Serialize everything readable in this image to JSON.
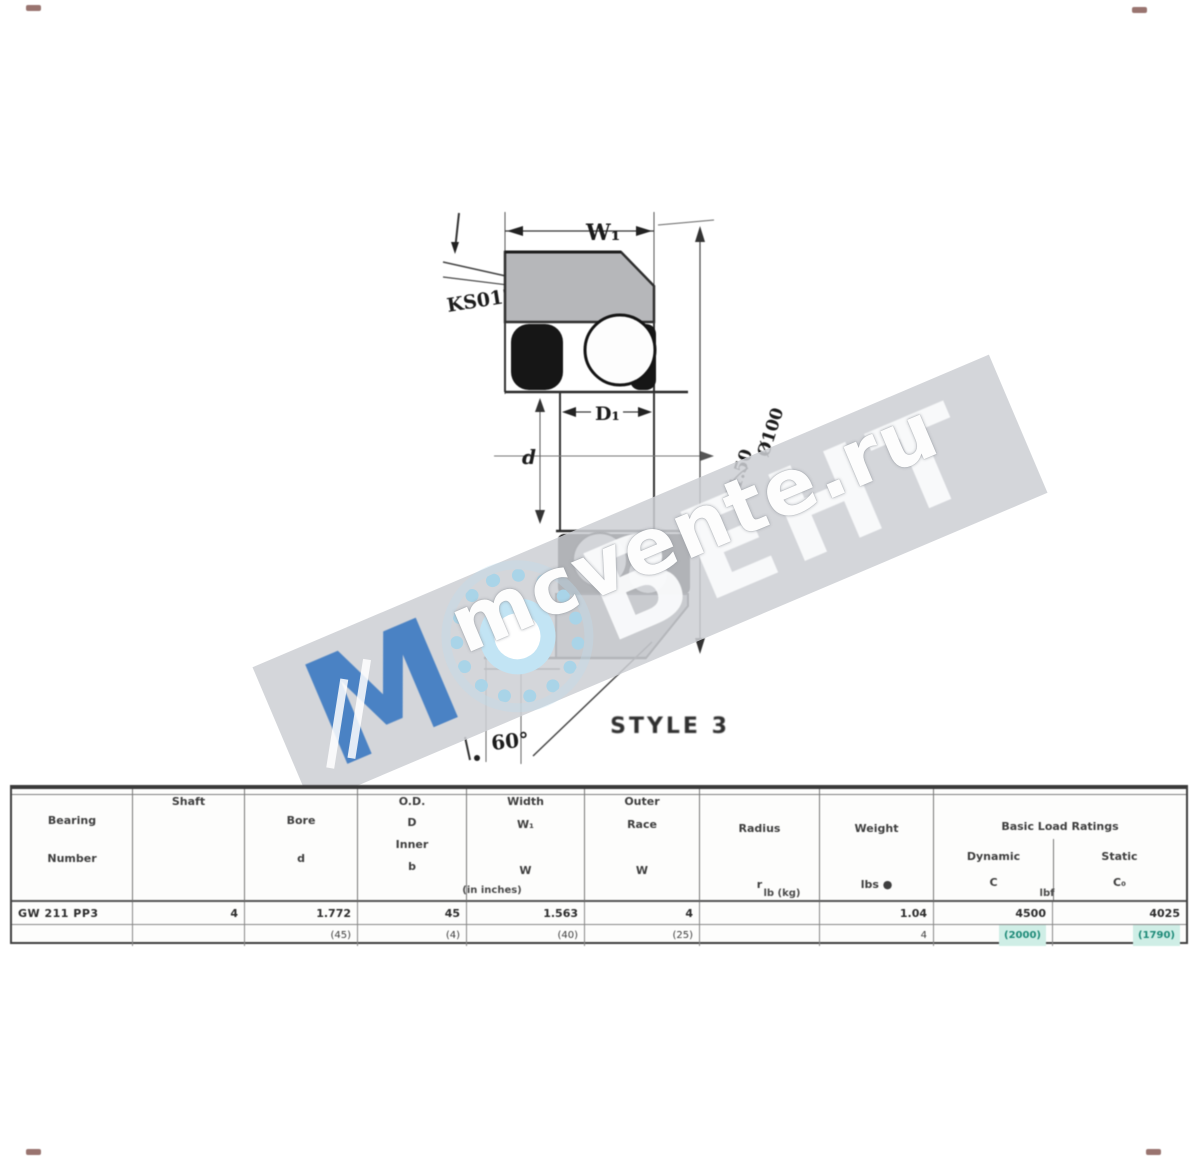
{
  "watermark": {
    "brand_m": "М",
    "brand_rest": "ВЕНТ",
    "site": "mcvente.ru",
    "band_color": "#cfd1d5",
    "blue": "#4a82c4",
    "light_blue": "#a9d4e8"
  },
  "diagram": {
    "labels": {
      "w1": "W₁",
      "d1": "D₁",
      "d": "d",
      "angle": "60°",
      "style": "STYLE 3",
      "callout_left": "KS012",
      "callout_right_1": "Ø1.50",
      "callout_right_2": "Ø100"
    },
    "colors": {
      "ring_gray": "#b6b7ba",
      "line": "#2a2a2a",
      "seal_black": "#161616"
    }
  },
  "table": {
    "header": {
      "col1": [
        "Bearing",
        "Number"
      ],
      "col2": [
        "Shaft"
      ],
      "col3": [
        "Bore",
        "d"
      ],
      "col4": [
        "O.D.",
        "D",
        "Inner",
        "b"
      ],
      "col5": [
        "Width",
        "W₁",
        "W"
      ],
      "col6": [
        "Outer",
        "Race",
        "W"
      ],
      "col7": [
        "Radius",
        "r"
      ],
      "col8": [
        "Weight",
        "lbs ●"
      ],
      "group": "Basic Load Ratings",
      "sub1": "Dynamic",
      "sub2": "Static",
      "sym1": "C",
      "sym2": "C₀",
      "note_left": "(in inches)",
      "note_mid": "lb (kg)",
      "note_right": "lbf"
    },
    "rows": [
      {
        "c1": "GW 211 PP3",
        "c2": "4",
        "c3": "1.772",
        "c4": "45",
        "c5": "1.563",
        "c6": "4",
        "c7": "",
        "c8": "1.04",
        "c9a": "4500",
        "c9b": "4025"
      },
      {
        "c1": "",
        "c2": "",
        "c3": "(45)",
        "c4": "(4)",
        "c5": "(40)",
        "c6": "(25)",
        "c7": "",
        "c8": "4",
        "c9a": "(2000)",
        "c9b": "(1790)"
      }
    ],
    "highlight": {
      "bg": "#cfeee6",
      "text": "#1d8a78"
    }
  }
}
